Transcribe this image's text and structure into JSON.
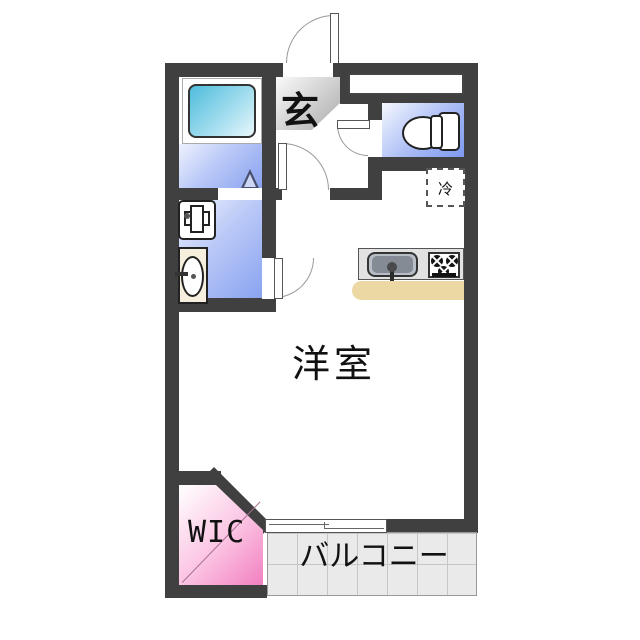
{
  "floor_plan": {
    "labels": {
      "entrance": "玄",
      "main_room": "洋室",
      "walk_in_closet": "WIC",
      "balcony": "バルコニー",
      "refrigerator": "冷"
    },
    "colors": {
      "wall": "#404040",
      "wet_area_floor_start": "#eef2fe",
      "wet_area_floor_end": "#8aa3f0",
      "bathtub_start": "#4fbcdb",
      "bathtub_end": "#e9f7fb",
      "wic_start": "#ffffff",
      "wic_end": "#f27fc1",
      "genkan_start": "#fafafa",
      "genkan_end": "#aaaaaa",
      "balcony_tile": "#eaeaea",
      "kitchen_counter_edge": "#ecd8a2"
    }
  }
}
